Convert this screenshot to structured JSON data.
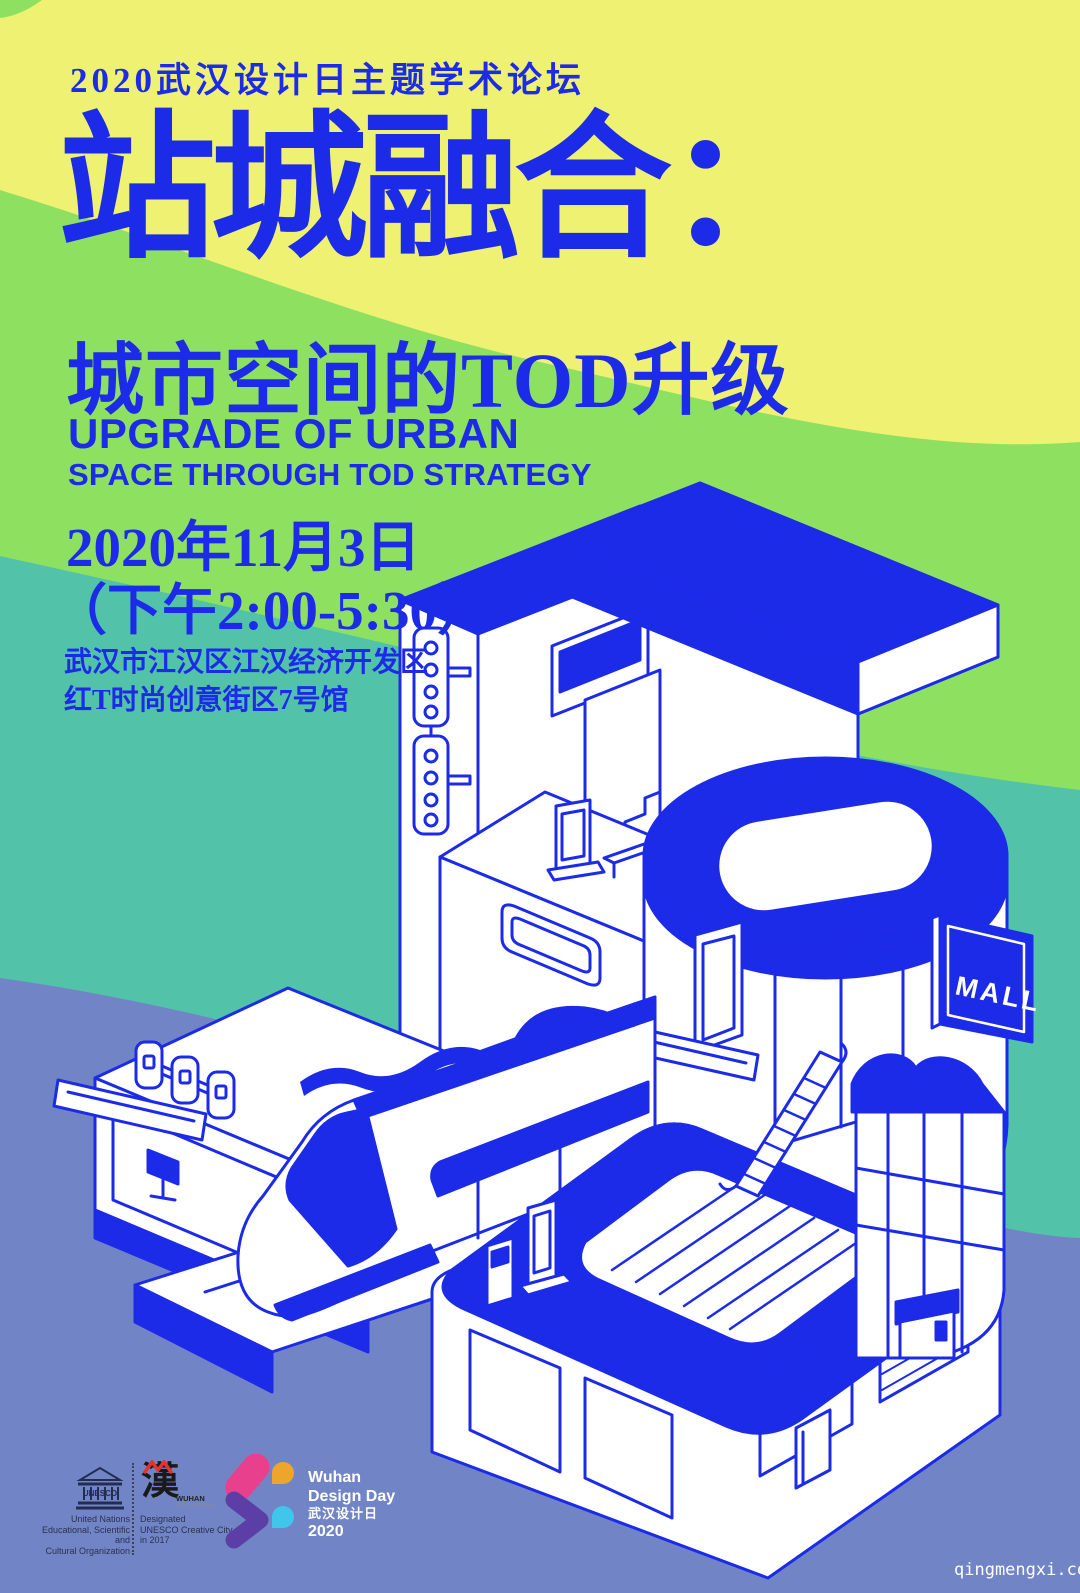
{
  "poster": {
    "tagline": "2020武汉设计日主题学术论坛",
    "title": "站城融合：",
    "subtitle": "城市空间的TOD升级",
    "subtitle_en_line1": "UPGRADE OF URBAN",
    "subtitle_en_line2": "SPACE THROUGH TOD STRATEGY",
    "date": "2020年11月3日",
    "time": "（下午2:00-5:30）",
    "address_line1": "武汉市江汉区江汉经济开发区",
    "address_line2": "红T时尚创意街区7号馆"
  },
  "illustration": {
    "mall_sign_label": "MALL"
  },
  "footer": {
    "unesco_logo_text": "UNESCO",
    "unesco_caption_line1": "United Nations",
    "unesco_caption_line2": "Educational, Scientific and",
    "unesco_caption_line3": "Cultural Organization",
    "wuhan_logo_char": "漢",
    "wuhan_logo_name_line1": "WUHAN",
    "wuhan_logo_name_line2": "CITY OF DESIGN",
    "wuhan_caption_line1": "Designated",
    "wuhan_caption_line2": "UNESCO Creative City",
    "wuhan_caption_line3": "in 2017",
    "wdd_line1": "Wuhan",
    "wdd_line2": "Design Day",
    "wdd_line3": "武汉设计日",
    "wdd_line4": "2020"
  },
  "watermark": "qingmengxi.com",
  "colors": {
    "yellow": "#EFF172",
    "green": "#8EE061",
    "teal": "#52C3A8",
    "slate": "#7185C6",
    "blue": "#1C2BE8"
  }
}
